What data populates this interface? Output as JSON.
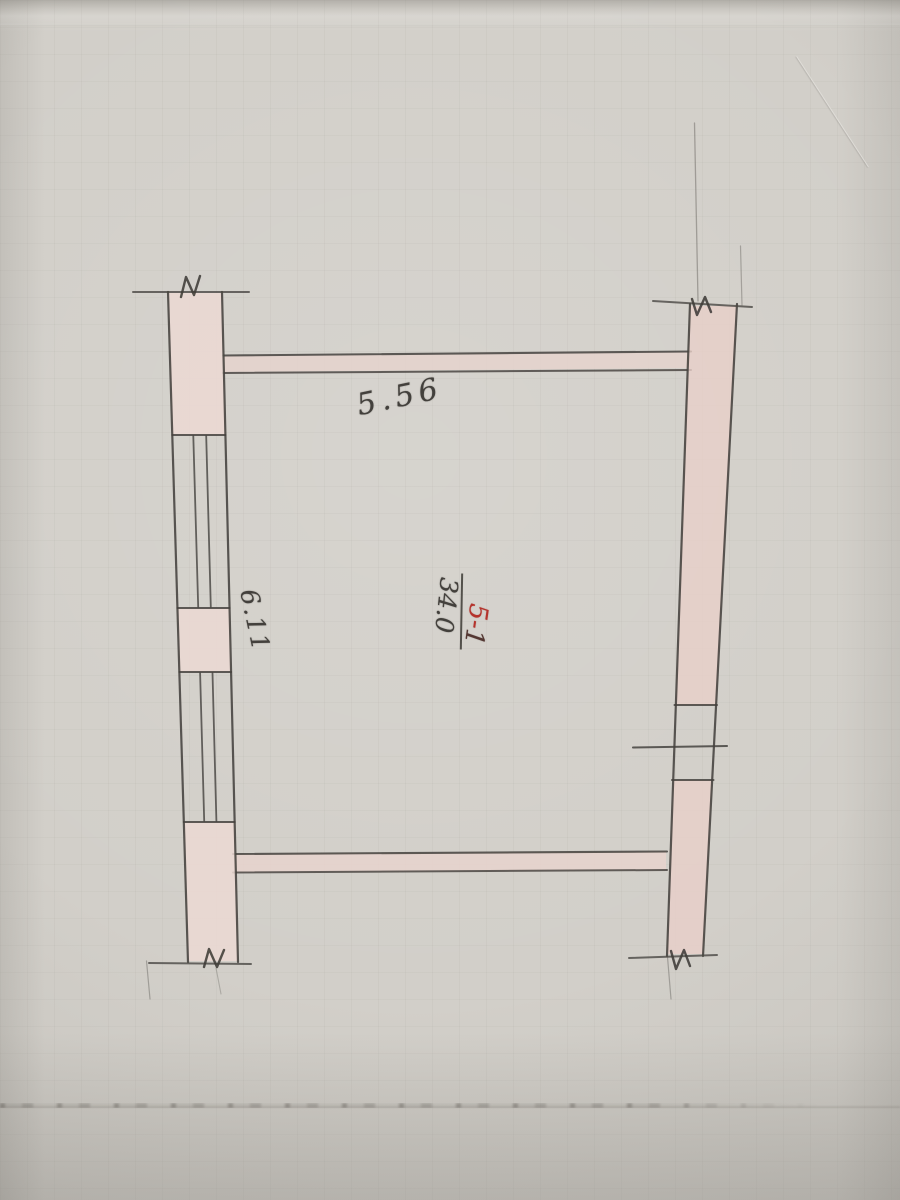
{
  "labels": {
    "top_wall_dimension": "5.56",
    "left_wall_dimension": "6.11",
    "room_numerator_red": "5-",
    "room_numerator_dark": "1",
    "room_area": "34.0"
  },
  "colors": {
    "paper": "#d2cfc9",
    "graphite_pencil": "#45423e",
    "wall_fill_pink": "#e9d6d0",
    "right_wall_fill_pink": "#e8d0c9",
    "red_ink": "#b5332c",
    "grid_line": "#8c8a82"
  },
  "symbols": {
    "break_mark": "zigzag wall-break symbol",
    "window_glazing": "double inner lines in left wall",
    "fraction_bar": "room number over area"
  }
}
